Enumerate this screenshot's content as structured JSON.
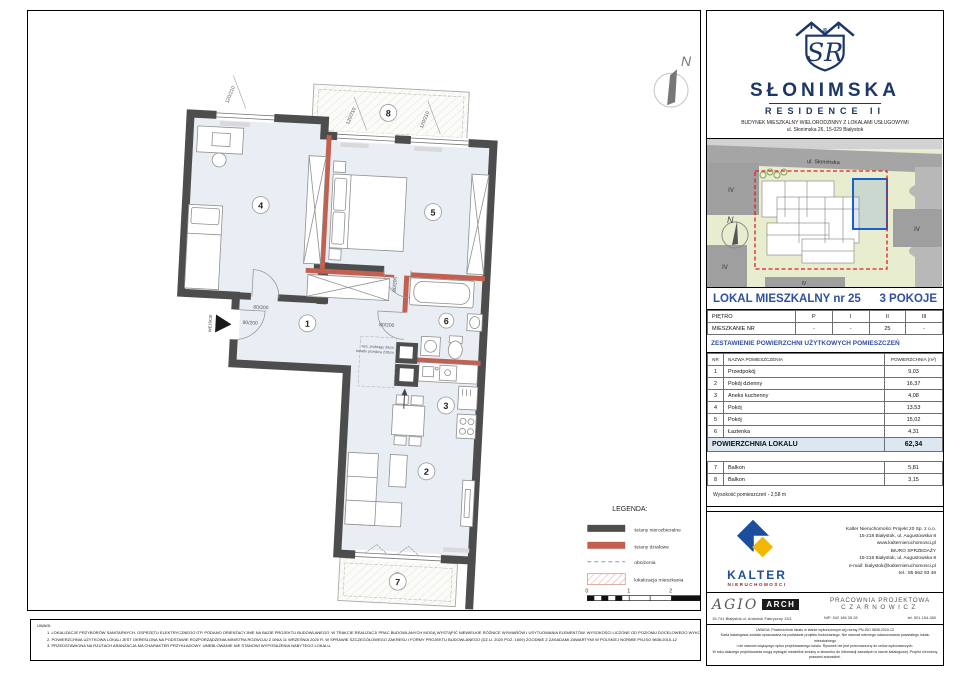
{
  "plan": {
    "north_label": "N",
    "entrance_label": "WEJŚCIE",
    "room_numbers": {
      "n1": "1",
      "n2": "2",
      "n3": "3",
      "n4": "4",
      "n5": "5",
      "n6": "6",
      "n7": "7",
      "n8": "8"
    },
    "dims": {
      "window": "120/210",
      "door": "80/200",
      "entry_door": "90/200",
      "balcony_door": "230/220"
    },
    "beam_note_line1": "wys. podciągu 28cm",
    "beam_note_line2": "światło przejścia 230cm"
  },
  "legend": {
    "title": "LEGENDA:",
    "items": [
      {
        "label": "ściany nierozbieralne"
      },
      {
        "label": "ściany działowe"
      },
      {
        "label": "obniżenia"
      },
      {
        "label": "lokalizacja mieszkania"
      }
    ],
    "scale_ticks": [
      "0",
      "1",
      "2",
      "3"
    ]
  },
  "notes": {
    "title": "UWAGI:",
    "items": [
      "1.   LOKALIZACJE PRZYBORÓW SANITARNYCH, OSPRZĘTU ELEKTRYCZNEGO ITP. PODANO ORIENTACYJNIE NA BAZIE PROJEKTU BUDOWLANEGO. W TRAKCIE REALIZACJI PRAC BUDOWLANYCH MOGĄ WYSTĄPIĆ NIEWIELKIE RÓŻNICE WYMIARÓW I USYTUOWANIA ELEMENTÓW. WYSOKOŚCI LICZONE OD POZIOMU DOCELOWEGO WYKOŃCZENIA PODŁOGI.",
      "2.   POWIERZCHNIA UŻYTKOWA LOKALI JEST OKREŚLONA NA PODSTAWIE ROZPORZĄDZENIA MINISTRA ROZWOJU Z DNIA 11 WRZEŚNIA 2020 R. W SPRAWIE SZCZEGÓŁOWEGO ZAKRESU I FORMY PROJEKTU BUDOWLANEGO (DZ.U. 2020 POZ. 1609) ZGODNIE Z ZASADAMI ZAWARTYMI W POLSKIEJ NORMIE PN-ISO 9836:2015-12",
      "3.   PRZEDSTAWIONA NA RZUTACH ARANŻACJA MA CHARAKTER PRZYKŁADOWY. UMEBLOWANIE NIE STANOWI WYPOSAŻENIA NABYTEGO LOKALU."
    ]
  },
  "sidebar": {
    "logo": {
      "monogram": "SR",
      "roman": "II",
      "name": "SŁONIMSKA",
      "subname": "RESIDENCE II",
      "desc": "BUDYNEK MIESZKALNY WIELORODZINNY Z LOKALAMI USŁUGOWYMI",
      "address": "ul. Słonimska 26, 15-029 Białystok"
    },
    "siteplan": {
      "street": "ul. Słonimska",
      "block_label": "IV",
      "north_label": "N"
    },
    "title": {
      "left": "LOKAL MIESZKALNY  nr 25",
      "right": "3 POKOJE"
    },
    "floor_table": {
      "rows": [
        [
          "PIĘTRO",
          "P",
          "I",
          "II",
          "III"
        ],
        [
          "MIESZKANIE NR",
          "-",
          "-",
          "25",
          "-"
        ]
      ]
    },
    "area_heading": "ZESTAWIENIE POWIERZCHNI UŻYTKOWYCH POMIESZCZEŃ",
    "area_table": {
      "headers": [
        "NR",
        "NAZWA POMIESZCZENIA",
        "POWIERZCHNIA (m²)"
      ],
      "rows": [
        [
          "1",
          "Przedpokój",
          "9,03"
        ],
        [
          "2",
          "Pokój dzienny",
          "16,37"
        ],
        [
          "3",
          "Aneks kuchenny",
          "4,08"
        ],
        [
          "4",
          "Pokój",
          "13,53"
        ],
        [
          "5",
          "Pokój",
          "15,02"
        ],
        [
          "6",
          "Łazienka",
          "4,31"
        ]
      ],
      "total_label": "POWIERZCHNIA LOKALU",
      "total_value": "62,34",
      "balcony_rows": [
        [
          "7",
          "Balkon",
          "5,81"
        ],
        [
          "8",
          "Balkon",
          "3,15"
        ]
      ],
      "height_note": "Wysokość pomieszczeń - 2,58 m"
    },
    "kalter": {
      "name": "KALTER",
      "sub": "NIERUCHOMOŚCI",
      "lines": [
        "Kalter Nieruchomości Projekt 20  Sp. z o.o.",
        "15-218 Białystok, ul. Augustowska 8",
        "www.kalternieruchomosci.pl",
        "BIURO SPRZEDAŻY",
        "15-218 Białystok, ul. Augustowska 8",
        "e-mail: bialystok@kalternieruchomosci.pl",
        "tel.: 85 662 93 48"
      ]
    },
    "agio": {
      "name": "AGIO",
      "arch": "ARCH",
      "address": "15-741 Białystok   ul. Antoniuk Fabryczny 13/1",
      "pracownia_line1": "PRACOWNIA PROJEKTOWA",
      "pracownia_line2": "CZARNOWICZ",
      "nip": "NIP:  542 186 35 28",
      "tel": "tel. 501-154-380"
    },
    "disclaimer": [
      "UWAGA:  Powierzchnia lokalu w stanie wykończonym wg normy PN-ISO 9836:2015-12",
      "Karta katalogowa została opracowana na podstawie projektu budowlanego.  Nie stanowi wiernego odwzorowania powstałego lokalu mieszkalnego",
      "i nie stanowi wiążącego opisu projektowanego lokalu. Rysunek nie jest przeznaczony do celów wykonawczych.",
      "W toku dalszego projektowania mogą wystąpić niewielkie zmiany w stosunku do informacji zawartych w karcie katalogowej. Projekt chroniony prawami autorskimi."
    ]
  }
}
